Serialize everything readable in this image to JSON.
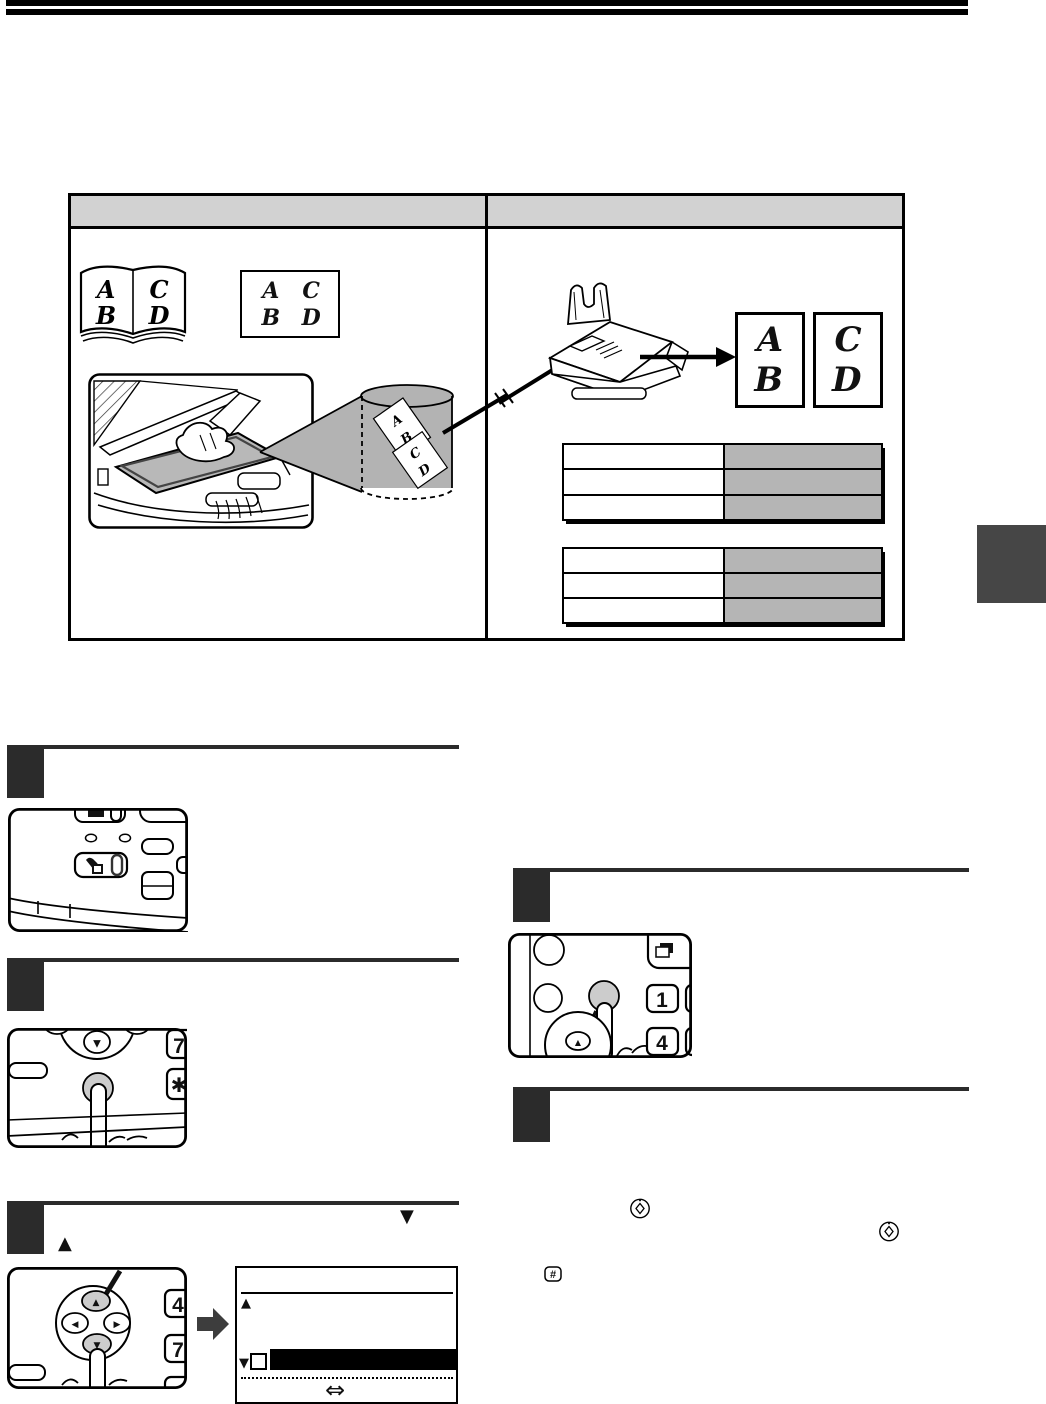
{
  "letters": {
    "a": "A",
    "b": "B",
    "c": "C",
    "d": "D"
  },
  "keys": {
    "one": "1",
    "four": "4",
    "seven": "7",
    "star": "✱",
    "hash": "#"
  },
  "glyphs": {
    "up": "▲",
    "down": "▼",
    "left": "◀",
    "right": "▶",
    "double_arrow": "⇔"
  },
  "colors": {
    "header_bar": "#000000",
    "step_block": "#2b2b2b",
    "table_header_fill": "#d2d2d2",
    "spec_value_fill": "#b5b5b5",
    "cylinder_fill": "#b3b3b3",
    "side_tab_fill": "#464646",
    "pressed_key_fill": "#cccccc",
    "block_arrow_fill": "#3d3d3d"
  },
  "comparison_table": {
    "columns": 2,
    "header_text_left": "",
    "header_text_right": ""
  },
  "spec_tables": {
    "table1_rows": 3,
    "table2_rows": 3
  }
}
